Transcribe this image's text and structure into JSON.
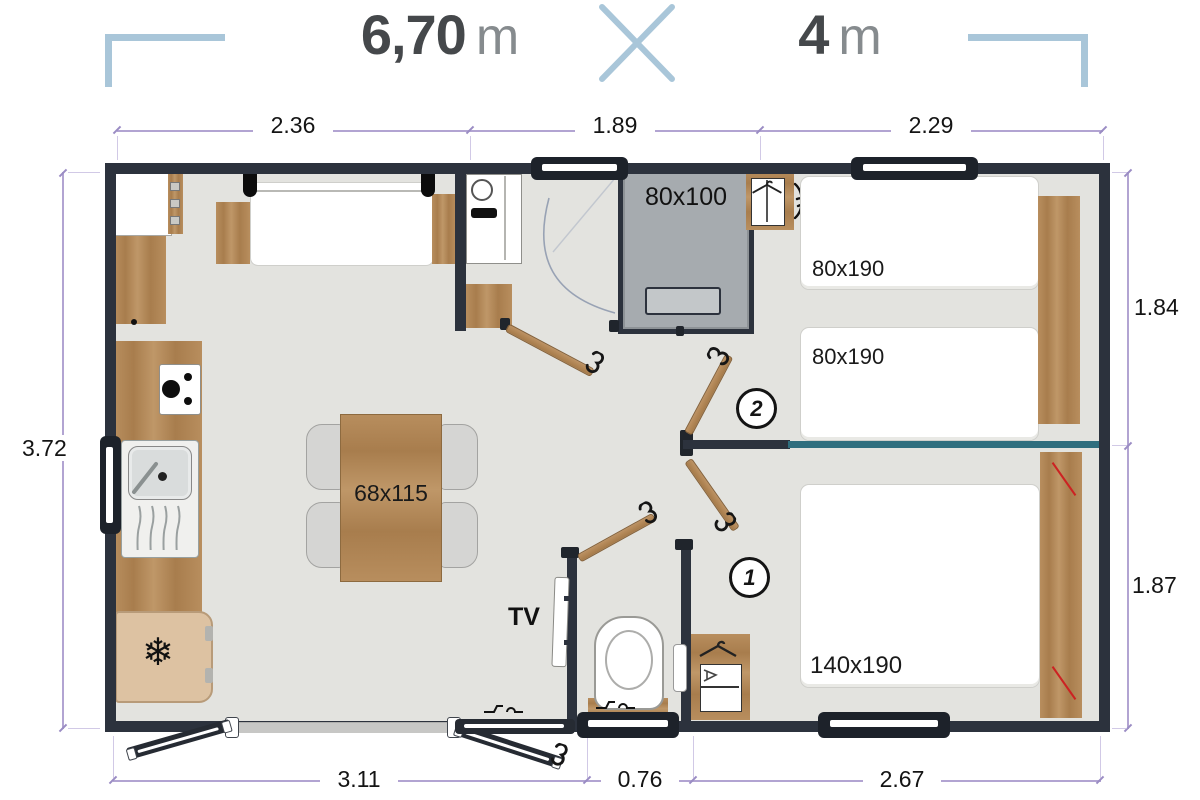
{
  "title": {
    "width_value": "6,70",
    "width_unit": "m",
    "separator": "x",
    "length_value": "4",
    "length_unit": "m"
  },
  "dims": {
    "top": [
      "2.36",
      "1.89",
      "2.29"
    ],
    "left": "3.72",
    "right_top": "1.84",
    "right_bottom": "1.87",
    "bottom": [
      "3.11",
      "0.76",
      "2.67"
    ]
  },
  "labels": {
    "shower": "80x100",
    "bed_single": "80x190",
    "bed_double": "140x190",
    "table": "68x115",
    "tv": "TV",
    "room1": "1",
    "room2": "2"
  },
  "icons": {
    "snowflake": "❄"
  },
  "colors": {
    "accent_blue": "#a9c6d9",
    "wall_dark": "#2c323d",
    "wood": "#b88e5e",
    "floor": "#e3e3df",
    "teal_partition": "#2f6e7e",
    "dimension_line": "#b2a4d2",
    "shower_gray": "#a6abaf",
    "fridge_beige": "#ddc2a2",
    "red_accent": "#cc2222"
  }
}
